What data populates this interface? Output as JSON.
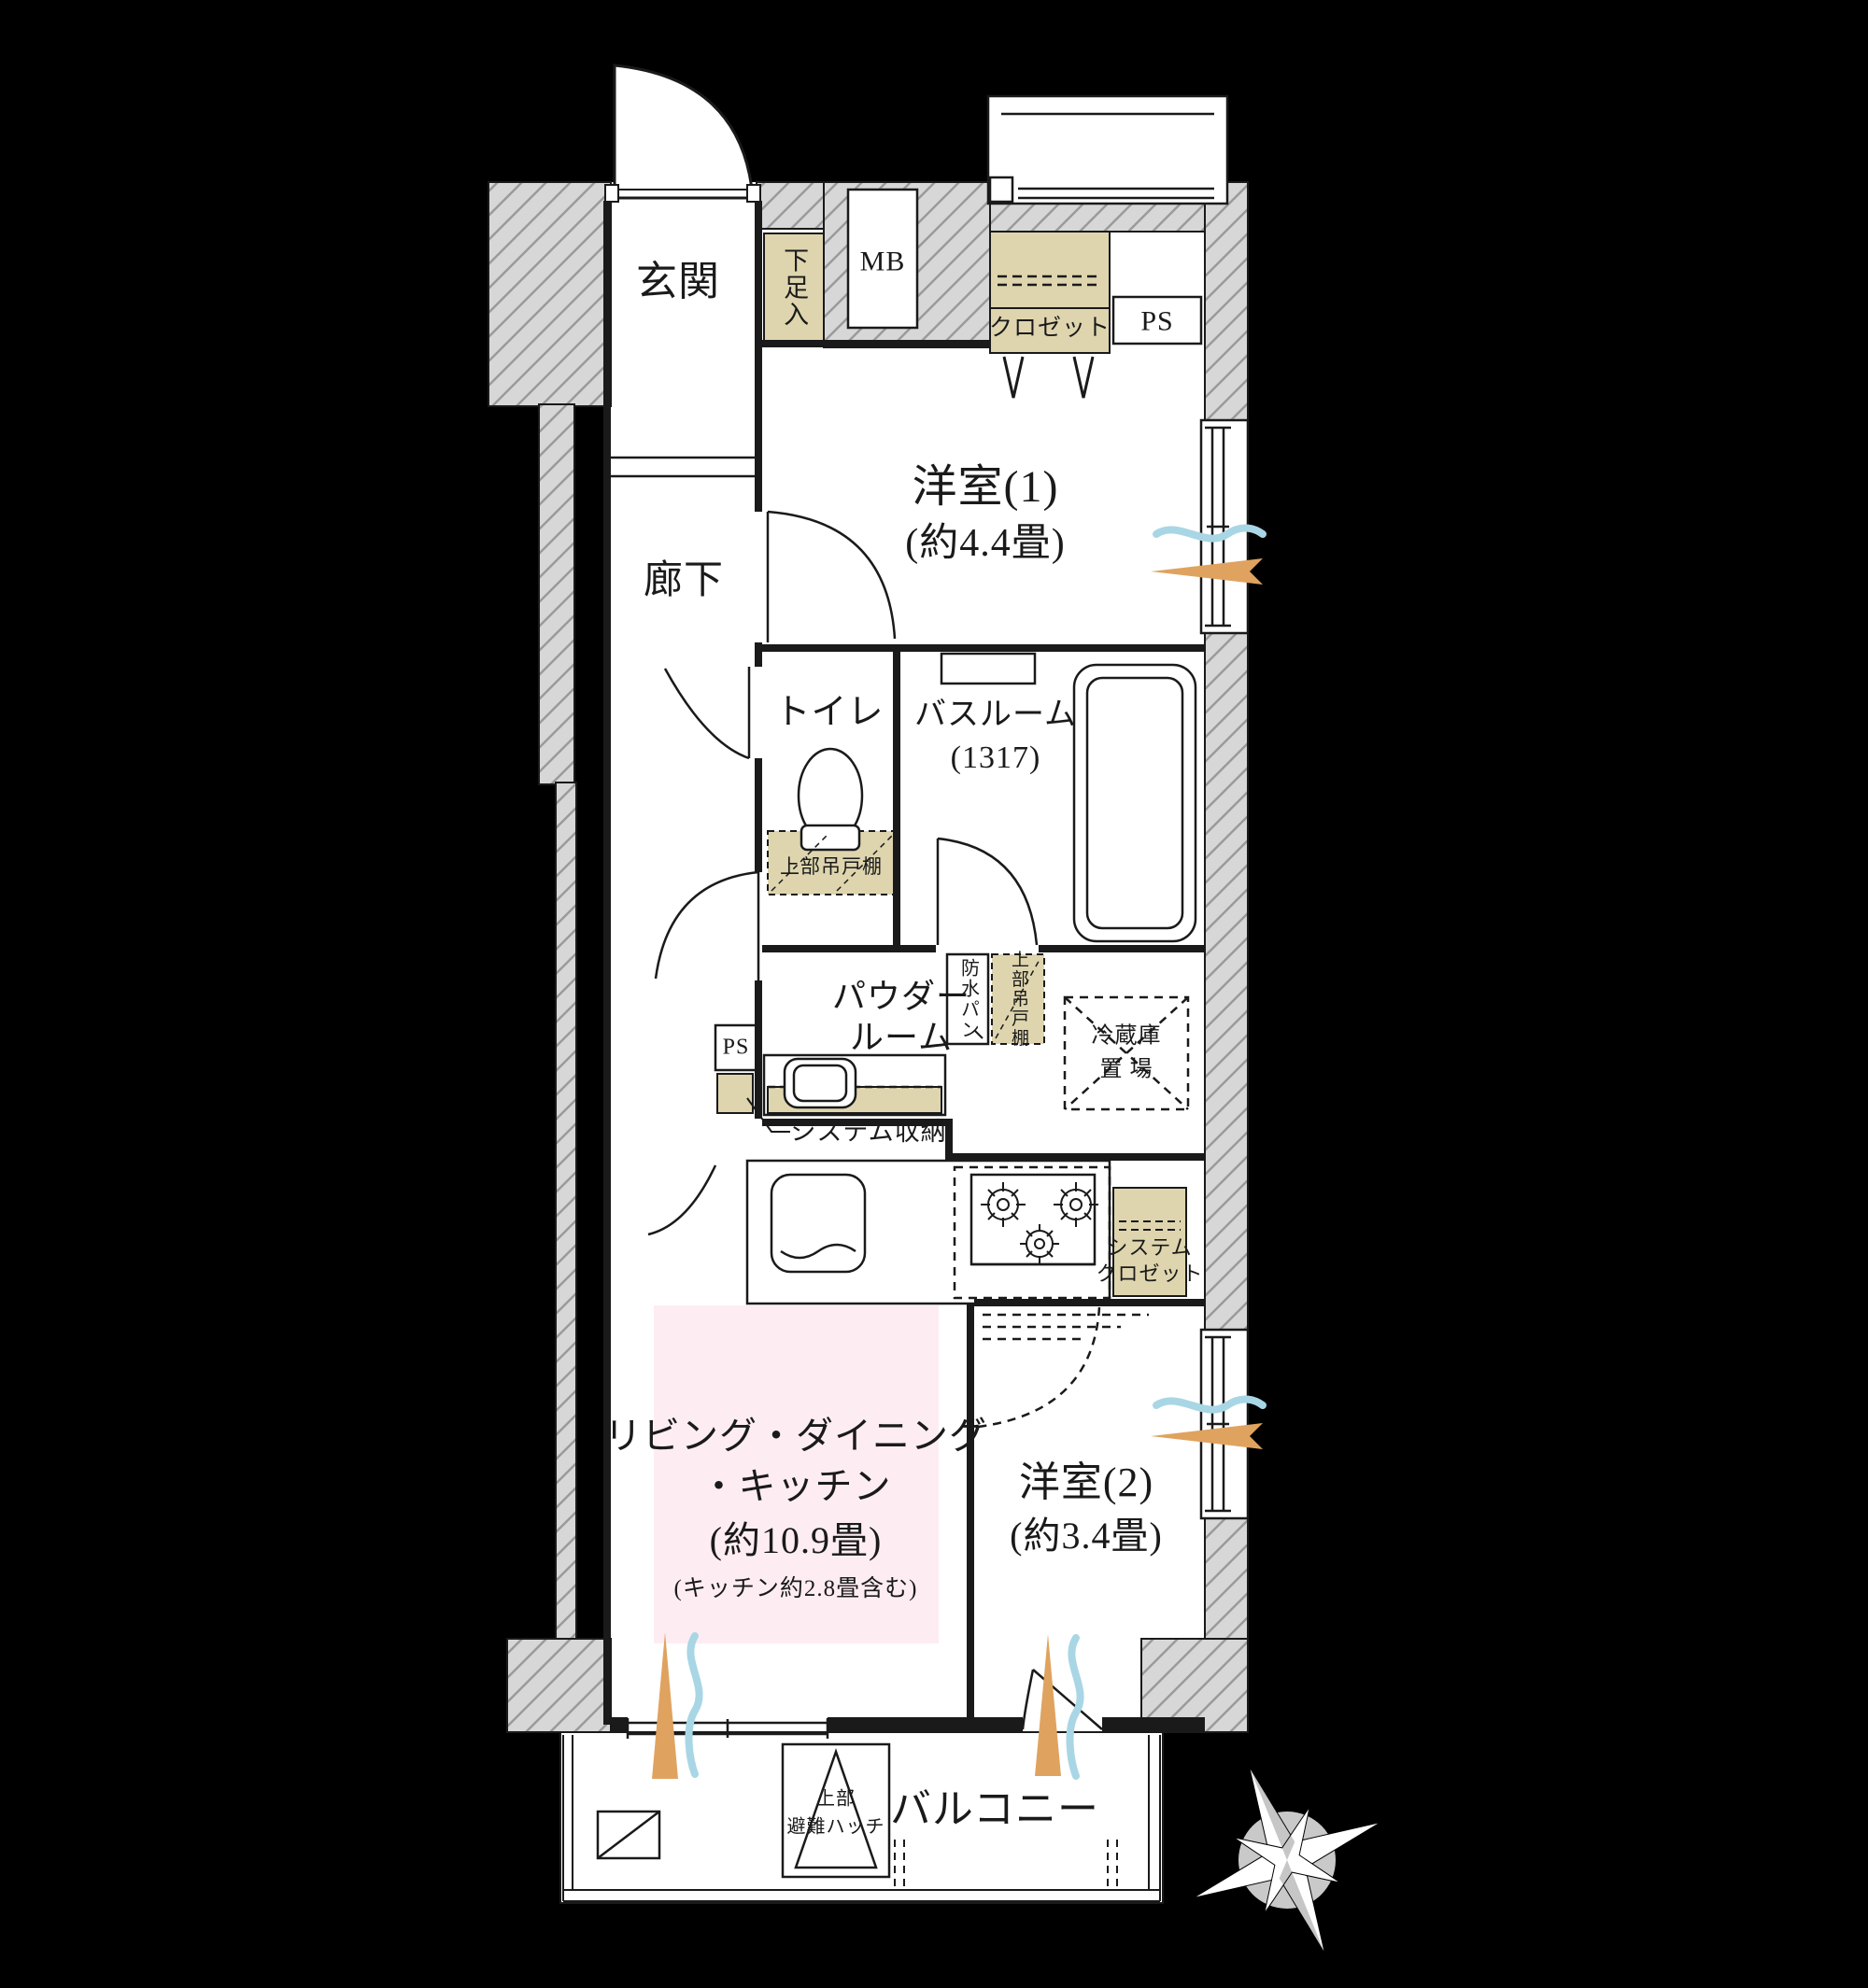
{
  "document_type": "apartment-floor-plan",
  "labels": {
    "genkan": "玄関",
    "shoe_cabinet": "下足入",
    "mb": "MB",
    "closet": "クロゼット",
    "ps_top": "PS",
    "room1": "洋室(1)",
    "room1_size": "(約4.4畳)",
    "corridor": "廊下",
    "toilet": "トイレ",
    "bathroom": "バスルーム",
    "bathroom_size": "(1317)",
    "toilet_cabinet": "上部吊戸棚",
    "powder_line1": "パウダー",
    "powder_line2": "ルーム",
    "waterproof_pan": "防水パン",
    "upper_cabinet": "上部吊戸棚",
    "ps_mid": "PS",
    "system_storage": "システム収納",
    "fridge_line1": "冷蔵庫",
    "fridge_line2": "置 場",
    "ldk_line1": "リビング・ダイニング",
    "ldk_line2": "・キッチン",
    "ldk_line3": "(約10.9畳)",
    "ldk_line4": "(キッチン約2.8畳含む)",
    "system_closet_line1": "システム",
    "system_closet_line2": "クロゼット",
    "room2": "洋室(2)",
    "room2_size": "(約3.4畳)",
    "balcony": "バルコニー",
    "hatch_line1": "上部",
    "hatch_line2": "避難ハッチ"
  },
  "rooms": [
    {
      "name": "玄関"
    },
    {
      "name": "廊下"
    },
    {
      "name": "洋室(1)",
      "size": "約4.4畳"
    },
    {
      "name": "トイレ"
    },
    {
      "name": "バスルーム",
      "size": "1317"
    },
    {
      "name": "パウダールーム"
    },
    {
      "name": "リビング・ダイニング・キッチン",
      "size": "約10.9畳",
      "note": "キッチン約2.8畳含む"
    },
    {
      "name": "洋室(2)",
      "size": "約3.4畳"
    },
    {
      "name": "バルコニー"
    }
  ],
  "colors": {
    "background": "#000000",
    "wall_gray": "#d7d7d7",
    "hatch_line": "#9a9a9a",
    "line_black": "#1a1a1a",
    "storage_tan": "#ded5ae",
    "ldk_pink": "#fdedf2",
    "breeze_blue": "#a9d6e5",
    "sunlight_orange": "#dfa35f",
    "compass_gray": "#c9c9c9"
  },
  "compass": true
}
